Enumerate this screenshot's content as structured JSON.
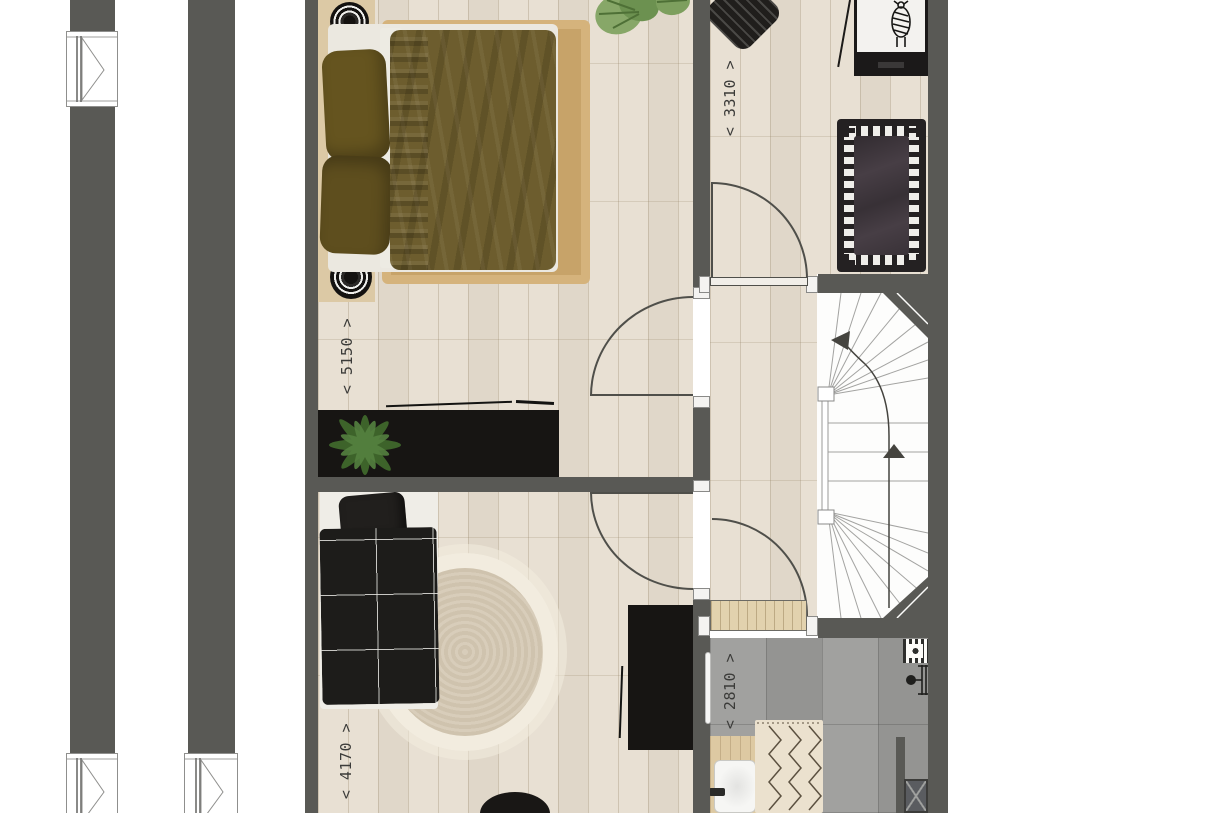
{
  "floorplan": {
    "dimension_labels": {
      "master_bedroom": "< 5150 >",
      "nursery": "< 3310 >",
      "kids_bedroom": "< 4170 >",
      "bathroom": "< 2810 >"
    },
    "colors": {
      "wall": "#595955",
      "wood_floor": "#e8e0d3",
      "tile_floor": "#9c9c9a",
      "stair_area": "#fdfdfc",
      "duvet_olive": "#6d5d2e",
      "jute_rug": "#c7a369",
      "headboard_runner": "#dcc9a5",
      "furniture_black": "#171513",
      "plant_green": "#4e7a36",
      "dimension_text": "#3b3b39"
    }
  }
}
